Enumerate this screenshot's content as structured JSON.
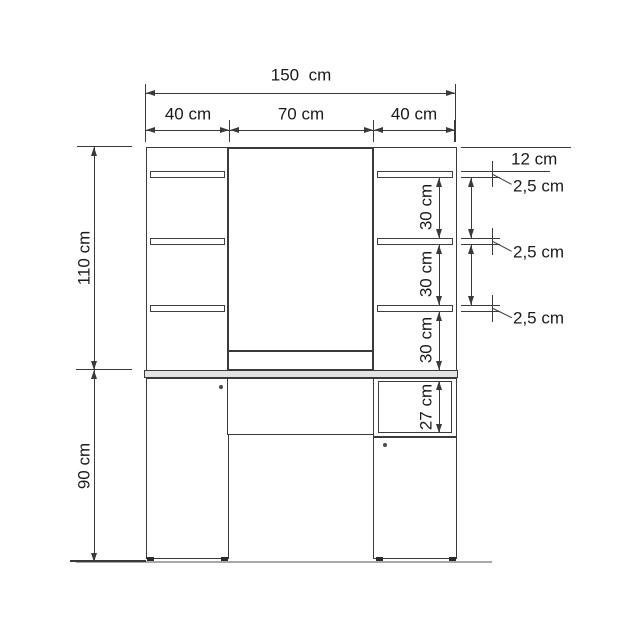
{
  "figure": {
    "kind": "furniture-dimension-diagram",
    "unit": "cm"
  },
  "labels": {
    "total_width": "150  cm",
    "left_section_width": "40 cm",
    "middle_section_width": "70 cm",
    "right_section_width": "40 cm",
    "upper_height": "110 cm",
    "lower_height": "90 cm",
    "top_to_first_shelf": "12 cm",
    "shelf_thickness_1": "2,5 cm",
    "shelf_thickness_2": "2,5 cm",
    "shelf_thickness_3": "2,5 cm",
    "shelf_spacing_1": "30 cm",
    "shelf_spacing_2": "30 cm",
    "shelf_spacing_3": "30 cm",
    "compartment_height": "27 cm"
  },
  "measurements_cm": {
    "total_width": 150,
    "left_section_width": 40,
    "middle_section_width": 70,
    "right_section_width": 40,
    "upper_height": 110,
    "lower_height": 90,
    "top_to_first_shelf": 12,
    "shelf_thickness": 2.5,
    "shelf_spacing": 30,
    "compartment_height": 27
  },
  "colors": {
    "line": "#3a3a3a",
    "text": "#1a1a1a",
    "floor_line": "#a8a8a8",
    "tabletop_fill": "#e3e3e3",
    "background": "#ffffff"
  }
}
